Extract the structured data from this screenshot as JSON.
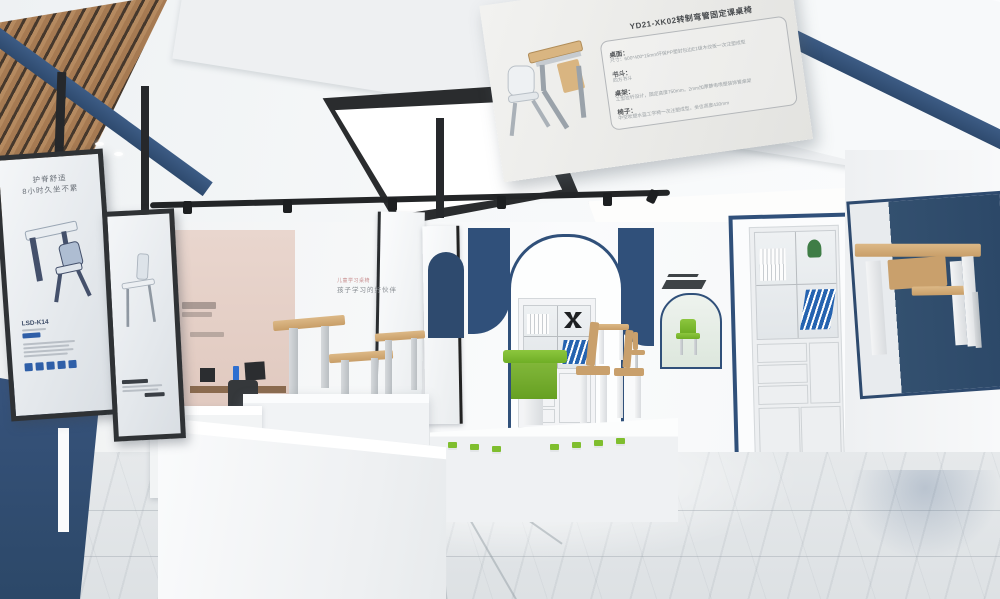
{
  "hanging_board": {
    "title": "YD21-XK02转制弯管固定课桌椅",
    "specs": [
      {
        "label": "桌面：",
        "text": "尺寸：600*400*15mm环保PP塑封包边E1级木纹板一次注塑成型"
      },
      {
        "label": "书斗：",
        "text": "四方书斗"
      },
      {
        "label": "桌架：",
        "text": "工型拉杆设计，固定高度750mm，2mm加厚静电喷塑装饰管桌架"
      },
      {
        "label": "椅子：",
        "text": "中空吹塑水蓝工学椅一次注塑成型，坐位高度430mm"
      }
    ]
  },
  "poster_left": {
    "heading_line1": "护脊舒适",
    "heading_line2": "8小时久坐不累",
    "model": "LSD-K14"
  },
  "wall_text_center": {
    "line1": "儿童学习桌椅",
    "line2": "孩子学习的好伙伴"
  },
  "colors": {
    "accent_blue": "#30507a",
    "dark_blue": "#2c4868",
    "lime_green": "#7fbe2e",
    "wood": "#c89e68",
    "pink_wall": "#e2cdc5",
    "frame_black": "#2f3235",
    "floor": "#e0e4e7"
  }
}
